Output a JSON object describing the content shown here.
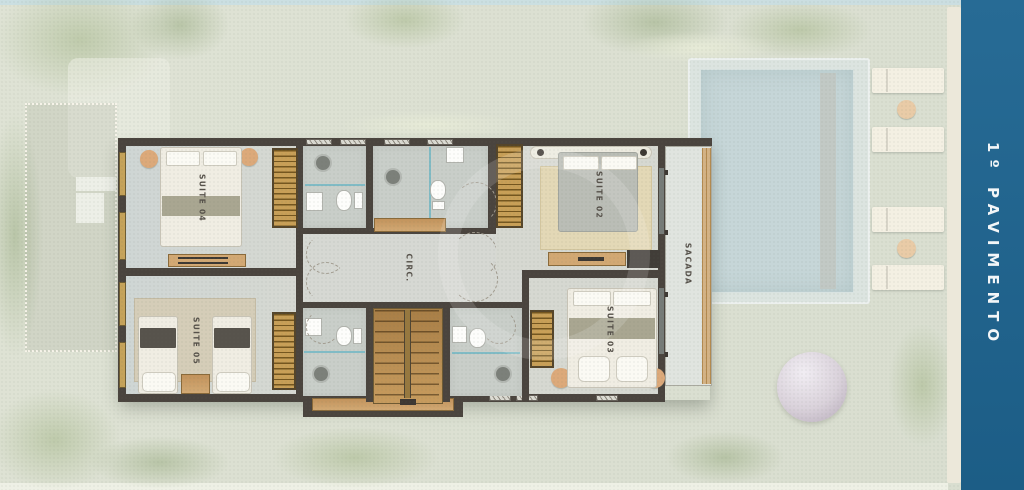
{
  "sidebar": {
    "title": "1º PAVIMENTO"
  },
  "floorplan": {
    "rooms": {
      "suite04": {
        "label": "SUITE 04"
      },
      "suite05": {
        "label": "SUITE 05"
      },
      "suite02": {
        "label": "SUITE 02"
      },
      "suite03": {
        "label": "SUITE 03"
      },
      "circulation": {
        "label": "CIRC."
      },
      "balcony": {
        "label": "SACADA"
      }
    },
    "colors": {
      "sidebar_blue": "#216490",
      "wall_dark": "#4a443e",
      "wood": "#c89f57",
      "pool_water": "#c6d6d8",
      "garden_green": "#dde1d3",
      "glass_blue": "#6fb7c4"
    }
  }
}
